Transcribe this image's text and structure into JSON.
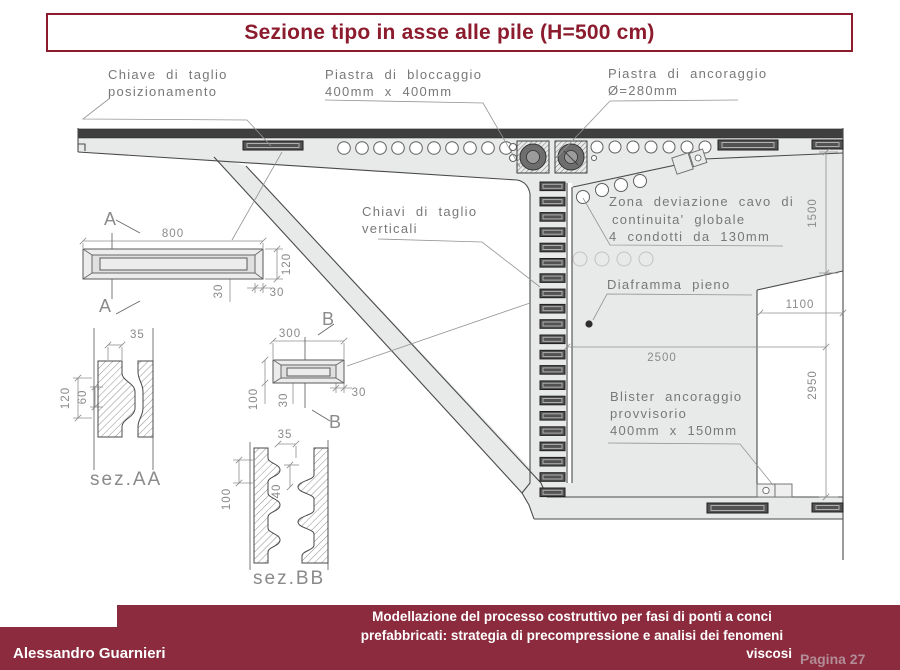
{
  "title": "Sezione tipo in asse alle pile (H=500 cm)",
  "colors": {
    "accent": "#8c1b2e",
    "footer_bg": "#8b2b3d",
    "drawing_fill": "#e8e9e9",
    "dark_key": "#525252",
    "page_number_text": "#b28c97"
  },
  "annotations": {
    "chiave_line1": "Chiave di taglio",
    "chiave_line2": "posizionamento",
    "bloccaggio_line1": "Piastra di bloccaggio",
    "bloccaggio_line2": "400mm x 400mm",
    "ancoraggio_line1": "Piastra di ancoraggio",
    "ancoraggio_line2": "Ø=280mm",
    "verticali_line1": "Chiavi di taglio",
    "verticali_line2": "verticali",
    "zona_line1": "Zona deviazione cavo di",
    "zona_line2": "continuita' globale",
    "zona_line3": "4 condotti da 130mm",
    "diaframma": "Diaframma pieno",
    "blister_line1": "Blister ancoraggio",
    "blister_line2": "provvisorio",
    "blister_line3": "400mm x 150mm"
  },
  "dims": {
    "d800": "800",
    "d120": "120",
    "d30": "30",
    "d35": "35",
    "d60": "60",
    "d300": "300",
    "d100": "100",
    "d40": "40",
    "d1500": "1500",
    "d1100": "1100",
    "d2950": "2950",
    "d2500": "2500"
  },
  "sections": {
    "a": "A",
    "b": "B",
    "sezAA": "sez.AA",
    "sezBB": "sez.BB"
  },
  "footer": {
    "author": "Alessandro Guarnieri",
    "title_line1": "Modellazione del processo costruttivo per fasi di ponti a conci",
    "title_line2": "prefabbricati: strategia di precompressione e analisi dei fenomeni",
    "title_line3": "viscosi",
    "page": "Pagina 27"
  }
}
